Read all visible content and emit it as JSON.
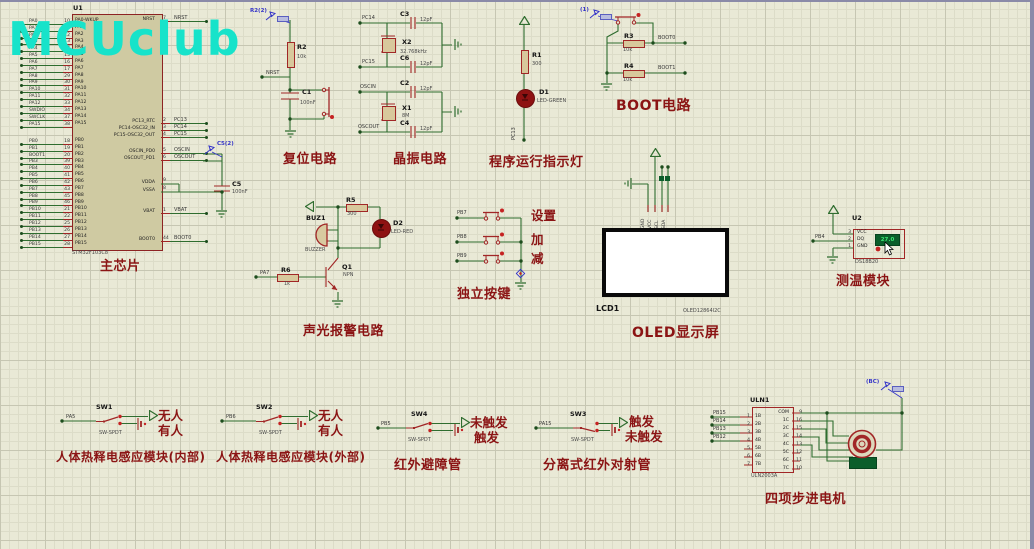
{
  "watermark": "MCUclub",
  "colors": {
    "canvas": "#e9e9d6",
    "wire": "#2f6d2f",
    "component": "#a12626",
    "caption": "#8b1414",
    "probe": "#3535c8",
    "chip_fill": "#cfcaa2",
    "display_bg": "#0b5e2b",
    "display_text": "#39e673",
    "watermark": "#17e3ca"
  },
  "chip": {
    "ref": "U1",
    "part": "STM32F103C8",
    "caption": "主芯片",
    "pa_pins": [
      {
        "net": "PA0",
        "num": "10",
        "name": "PA0-WKUP"
      },
      {
        "net": "PA1",
        "num": "11",
        "name": "PA1"
      },
      {
        "net": "PA2",
        "num": "12",
        "name": "PA2"
      },
      {
        "net": "PA3",
        "num": "13",
        "name": "PA3"
      },
      {
        "net": "PA4",
        "num": "14",
        "name": "PA4"
      },
      {
        "net": "PA5",
        "num": "15",
        "name": "PA5"
      },
      {
        "net": "PA6",
        "num": "16",
        "name": "PA6"
      },
      {
        "net": "PA7",
        "num": "17",
        "name": "PA7"
      },
      {
        "net": "PA8",
        "num": "29",
        "name": "PA8"
      },
      {
        "net": "PA9",
        "num": "30",
        "name": "PA9"
      },
      {
        "net": "PA10",
        "num": "31",
        "name": "PA10"
      },
      {
        "net": "PA11",
        "num": "32",
        "name": "PA11"
      },
      {
        "net": "PA12",
        "num": "33",
        "name": "PA12"
      },
      {
        "net": "SWDIO",
        "num": "34",
        "name": "PA13"
      },
      {
        "net": "SWCLK",
        "num": "37",
        "name": "PA14"
      },
      {
        "net": "PA15",
        "num": "38",
        "name": "PA15"
      }
    ],
    "pb_pins": [
      {
        "net": "PB0",
        "num": "18",
        "name": "PB0"
      },
      {
        "net": "PB1",
        "num": "19",
        "name": "PB1"
      },
      {
        "net": "BOOT1",
        "num": "20",
        "name": "PB2"
      },
      {
        "net": "PB3",
        "num": "39",
        "name": "PB3"
      },
      {
        "net": "PB4",
        "num": "40",
        "name": "PB4"
      },
      {
        "net": "PB5",
        "num": "41",
        "name": "PB5"
      },
      {
        "net": "PB6",
        "num": "42",
        "name": "PB6"
      },
      {
        "net": "PB7",
        "num": "43",
        "name": "PB7"
      },
      {
        "net": "PB8",
        "num": "45",
        "name": "PB8"
      },
      {
        "net": "PB9",
        "num": "46",
        "name": "PB9"
      },
      {
        "net": "PB10",
        "num": "21",
        "name": "PB10"
      },
      {
        "net": "PB11",
        "num": "22",
        "name": "PB11"
      },
      {
        "net": "PB12",
        "num": "25",
        "name": "PB12"
      },
      {
        "net": "PB13",
        "num": "26",
        "name": "PB13"
      },
      {
        "net": "PB14",
        "num": "27",
        "name": "PB14"
      },
      {
        "net": "PB15",
        "num": "28",
        "name": "PB15"
      }
    ],
    "right_names": [
      "NRST",
      "PC13_RTC",
      "PC14-OSC32_IN",
      "PC15-OSC32_OUT",
      "OSCIN_PD0",
      "OSCOUT_PD1",
      "VDDA",
      "VSSA",
      "VBAT",
      "BOOT0"
    ],
    "right_nets": [
      {
        "num": "7",
        "net": "NRST"
      },
      {
        "num": "2",
        "net": "PC13"
      },
      {
        "num": "3",
        "net": "PC14"
      },
      {
        "num": "4",
        "net": "PC15"
      },
      {
        "num": "5",
        "net": "OSCIN"
      },
      {
        "num": "6",
        "net": "OSCOUT"
      },
      {
        "num": "1",
        "net": "VBAT"
      },
      {
        "num": "44",
        "net": "BOOT0"
      }
    ],
    "vdda_num": "9",
    "vssa_num": "8",
    "c5_ref": "C5",
    "c5_val": "100nF",
    "probe": "C5(2)"
  },
  "reset": {
    "caption": "复位电路",
    "probe": "R2(2)",
    "r_ref": "R2",
    "r_val": "10k",
    "c_ref": "C1",
    "c_val": "100nF",
    "net": "NRST"
  },
  "crystal": {
    "caption": "晶振电路",
    "x2_ref": "X2",
    "x2_val": "32.768kHz",
    "c3_ref": "C3",
    "c3_val": "12pF",
    "c6_ref": "C6",
    "c6_val": "12pF",
    "net_pc14": "PC14",
    "net_pc15": "PC15",
    "x1_ref": "X1",
    "x1_val": "8M",
    "c2_ref": "C2",
    "c2_val": "12pF",
    "c4_ref": "C4",
    "c4_val": "12pF",
    "net_oscin": "OSCIN",
    "net_oscout": "OSCOUT"
  },
  "indicator": {
    "caption": "程序运行指示灯",
    "r_ref": "R1",
    "r_val": "300",
    "d_ref": "D1",
    "d_val": "LED-GREEN",
    "net": "PC13"
  },
  "boot": {
    "caption": "BOOT电路",
    "probe": "(1)",
    "r3_ref": "R3",
    "r3_val": "10k",
    "net_boot0": "BOOT0",
    "r4_ref": "R4",
    "r4_val": "10k",
    "net_boot1": "BOOT1"
  },
  "alarm": {
    "caption": "声光报警电路",
    "buz_ref": "BUZ1",
    "buz_val": "BUZZER",
    "r5_ref": "R5",
    "r5_val": "300",
    "d_ref": "D2",
    "d_val": "LED-RED",
    "q_ref": "Q1",
    "q_val": "NPN",
    "r6_ref": "R6",
    "r6_val": "1k",
    "net": "PA7"
  },
  "keys": {
    "caption": "独立按键",
    "rows": [
      {
        "net": "PB7",
        "label": "设置"
      },
      {
        "net": "PB8",
        "label": "加"
      },
      {
        "net": "PB9",
        "label": "减"
      }
    ]
  },
  "oled": {
    "caption": "OLED显示屏",
    "ref": "LCD1",
    "part": "OLED12864I2C",
    "pins": [
      "GND",
      "VCC",
      "SCL",
      "SDA"
    ]
  },
  "temp": {
    "caption": "测温模块",
    "ref": "U2",
    "part": "DS18B20",
    "reading": "27.0",
    "net": "PB4",
    "pins": [
      {
        "num": "3",
        "name": "VCC"
      },
      {
        "num": "2",
        "name": "DQ"
      },
      {
        "num": "1",
        "name": "GND"
      }
    ]
  },
  "pir1": {
    "caption": "人体热释电感应模块(内部)",
    "ref": "SW1",
    "part": "SW-SPDT",
    "net": "PA5",
    "top": "无人",
    "bot": "有人"
  },
  "pir2": {
    "caption": "人体热释电感应模块(外部)",
    "ref": "SW2",
    "part": "SW-SPDT",
    "net": "PB6",
    "top": "无人",
    "bot": "有人"
  },
  "ir1": {
    "caption": "红外避障管",
    "ref": "SW4",
    "part": "SW-SPDT",
    "net": "PB5",
    "top": "未触发",
    "bot": "触发"
  },
  "ir2": {
    "caption": "分离式红外对射管",
    "ref": "SW3",
    "part": "SW-SPDT",
    "net": "PA15",
    "top": "触发",
    "bot": "未触发"
  },
  "stepper": {
    "caption": "四项步进电机",
    "ref": "ULN1",
    "part": "ULN2003A",
    "probe": "(BC)",
    "left_pins": [
      {
        "num": "1",
        "name": "1B",
        "net": "PB15"
      },
      {
        "num": "2",
        "name": "2B",
        "net": "PB14"
      },
      {
        "num": "3",
        "name": "3B",
        "net": "PB13"
      },
      {
        "num": "4",
        "name": "4B",
        "net": "PB12"
      },
      {
        "num": "5",
        "name": "5B",
        "net": ""
      },
      {
        "num": "6",
        "name": "6B",
        "net": ""
      },
      {
        "num": "7",
        "name": "7B",
        "net": ""
      }
    ],
    "right_pins": [
      {
        "num": "9",
        "name": "COM"
      },
      {
        "num": "16",
        "name": "1C"
      },
      {
        "num": "15",
        "name": "2C"
      },
      {
        "num": "14",
        "name": "3C"
      },
      {
        "num": "13",
        "name": "4C"
      },
      {
        "num": "12",
        "name": "5C"
      },
      {
        "num": "11",
        "name": "6C"
      },
      {
        "num": "10",
        "name": "7C"
      }
    ]
  }
}
